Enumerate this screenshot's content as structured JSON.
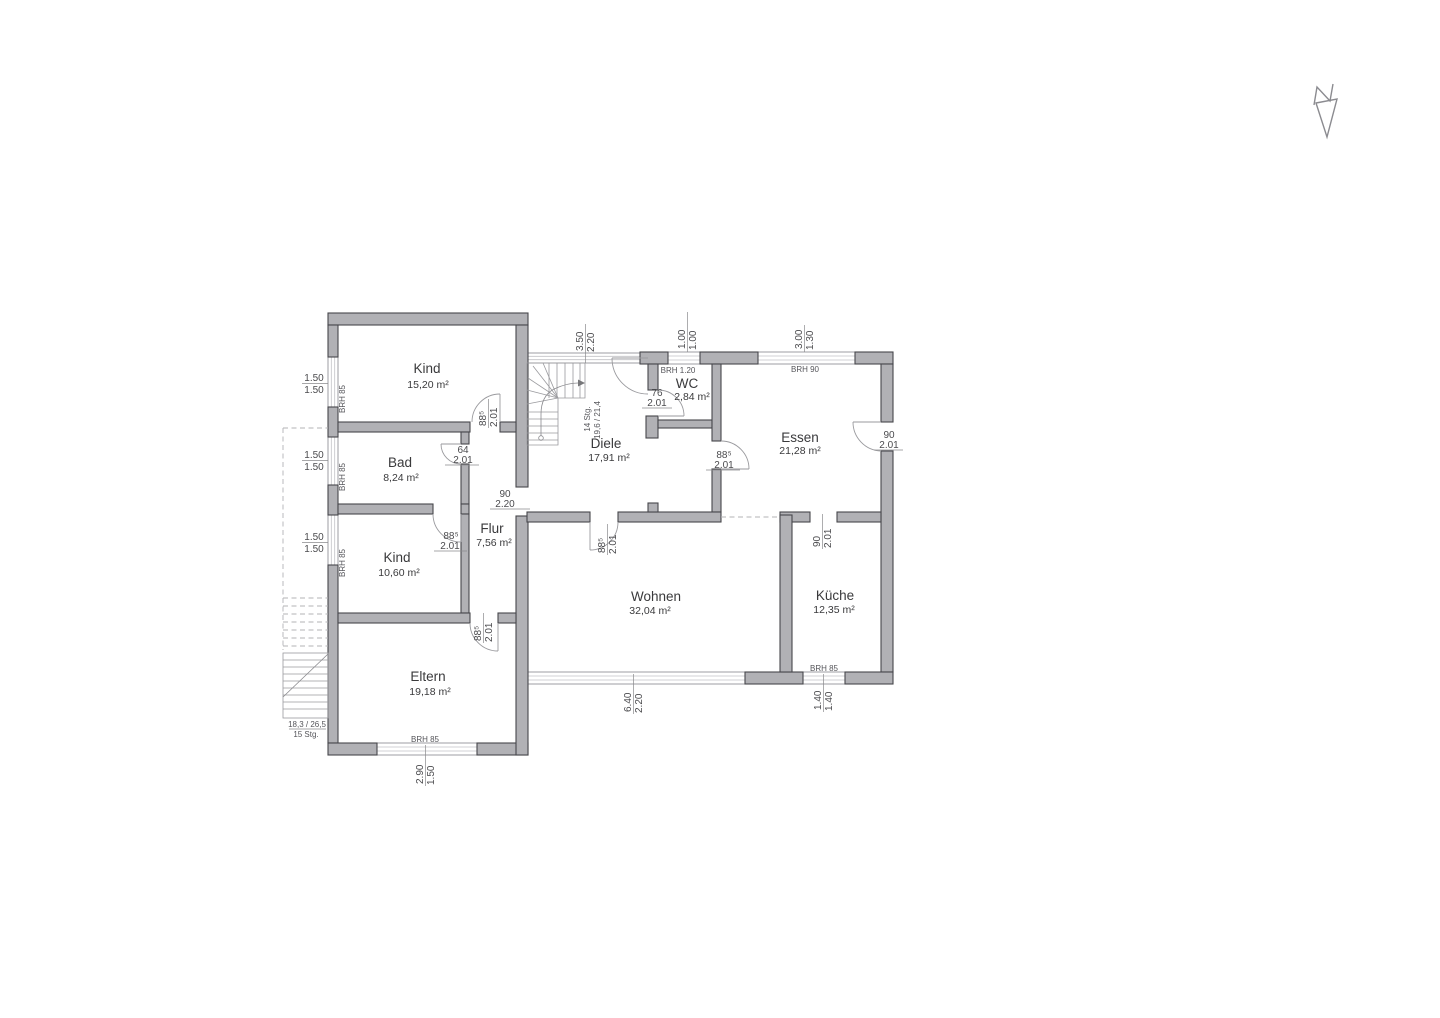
{
  "rooms": [
    {
      "name": "Kind",
      "area": "15,20 m²"
    },
    {
      "name": "Bad",
      "area": "8,24 m²"
    },
    {
      "name": "Kind",
      "area": "10,60 m²"
    },
    {
      "name": "Eltern",
      "area": "19,18 m²"
    },
    {
      "name": "Flur",
      "area": "7,56 m²"
    },
    {
      "name": "Diele",
      "area": "17,91 m²"
    },
    {
      "name": "WC",
      "area": "2,84 m²"
    },
    {
      "name": "Essen",
      "area": "21,28 m²"
    },
    {
      "name": "Wohnen",
      "area": "32,04 m²"
    },
    {
      "name": "Küche",
      "area": "12,35 m²"
    }
  ],
  "dims": {
    "win_left_1": {
      "a": "1.50",
      "b": "1.50"
    },
    "win_left_2": {
      "a": "1.50",
      "b": "1.50"
    },
    "win_left_3": {
      "a": "1.50",
      "b": "1.50"
    },
    "entry": {
      "a": "3.50",
      "b": "2.20"
    },
    "wc_win": {
      "a": "1.00",
      "b": "1.00"
    },
    "essen_win": {
      "a": "3.00",
      "b": "1.30"
    },
    "eltern_win": {
      "a": "2.90",
      "b": "1.50"
    },
    "wohnen_win": {
      "a": "6.40",
      "b": "2.20"
    },
    "kueche_win": {
      "a": "1.40",
      "b": "1.40"
    },
    "door_kind1": {
      "a": "88⁵",
      "b": "2.01"
    },
    "door_bad": {
      "a": "64",
      "b": "2.01"
    },
    "door_kind2": {
      "a": "88⁵",
      "b": "2.01"
    },
    "door_eltern": {
      "a": "88⁵",
      "b": "2.01"
    },
    "door_wohnen": {
      "a": "88⁵",
      "b": "2.01"
    },
    "door_wc": {
      "a": "76",
      "b": "2.01"
    },
    "door_essen": {
      "a": "88⁵",
      "b": "2.01"
    },
    "door_essen_ext": {
      "a": "90",
      "b": "2.01"
    },
    "door_kueche": {
      "a": "90",
      "b": "2.01"
    },
    "pass_flur": {
      "a": "90",
      "b": "2.20"
    }
  },
  "brh": {
    "b85": "BRH 85",
    "b90": "BRH 90",
    "b120": "BRH 1.20"
  },
  "stairs": {
    "internal_line1": "14 Stg.",
    "internal_line2": "19,6 / 21,4",
    "external_line1": "18,3 / 26,5",
    "external_line2": "15 Stg."
  },
  "icons": {
    "north_arrow": "north-arrow-compass"
  }
}
